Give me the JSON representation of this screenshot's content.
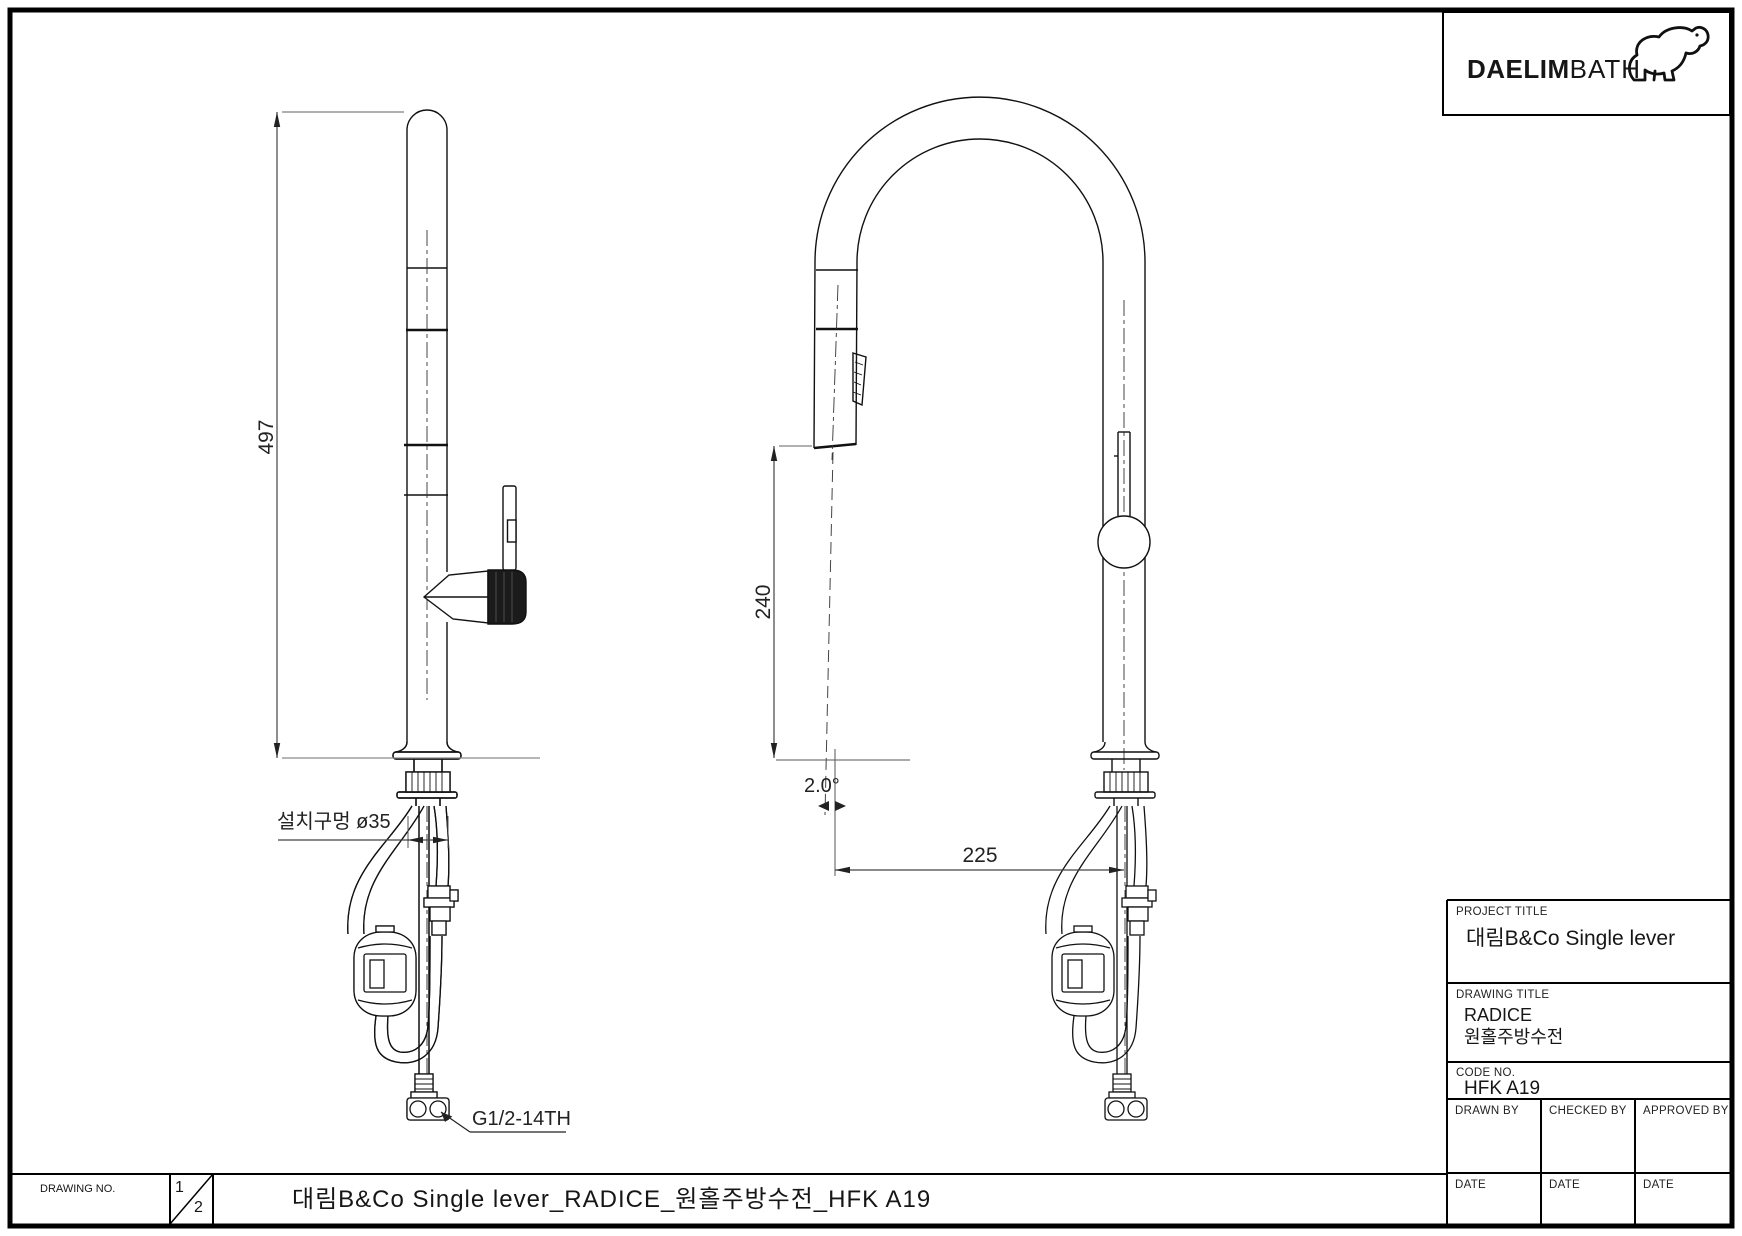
{
  "colors": {
    "line": "#111111",
    "dim_line": "#8a8a8a",
    "background": "#ffffff"
  },
  "logo": {
    "brand_bold": "DAELIM",
    "brand_light": "BATH"
  },
  "dimensions": {
    "height": "497",
    "spout_drop": "240",
    "reach": "225",
    "angle": "2.0°",
    "mounting_hole": "설치구멍 ø35",
    "thread": "G1/2-14TH"
  },
  "title_block": {
    "project_title_label": "PROJECT TITLE",
    "project_title": "대림B&Co Single lever",
    "drawing_title_label": "DRAWING TITLE",
    "drawing_title_line1": "RADICE",
    "drawing_title_line2": "원홀주방수전",
    "code_no_label": "CODE NO.",
    "code_no": "HFK A19",
    "drawn_by_label": "DRAWN BY",
    "checked_by_label": "CHECKED BY",
    "approved_by_label": "APPROVED BY",
    "date_label": "DATE"
  },
  "bottom_bar": {
    "drawing_no_label": "DRAWING NO.",
    "sheet_current": "1",
    "sheet_total": "2",
    "title": "대림B&Co Single lever_RADICE_원홀주방수전_HFK A19"
  }
}
